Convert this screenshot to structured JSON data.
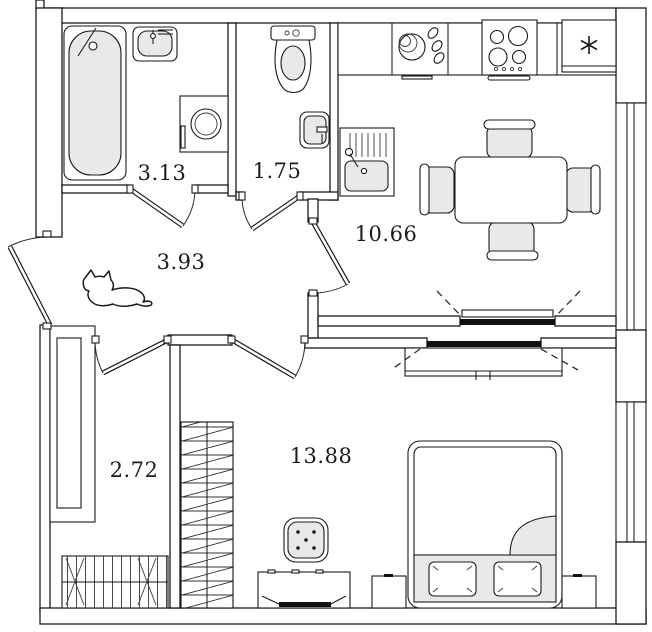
{
  "plan": {
    "type": "apartment-floor-plan",
    "rooms": [
      {
        "id": "bathroom",
        "area_label": "3.13"
      },
      {
        "id": "toilet",
        "area_label": "1.75"
      },
      {
        "id": "kitchen",
        "area_label": "10.66"
      },
      {
        "id": "hallway",
        "area_label": "3.93"
      },
      {
        "id": "corridor",
        "area_label": "2.72"
      },
      {
        "id": "bedroom",
        "area_label": "13.88"
      }
    ],
    "fixtures": [
      "bathtub",
      "bathroom-sink",
      "towel-rail",
      "washing-machine",
      "toilet",
      "toilet-sink",
      "kitchen-sink",
      "dish-rack",
      "stove",
      "fridge-asterisk",
      "dining-table",
      "chairs",
      "cat",
      "closet",
      "coat-rack",
      "wardrobe",
      "tv-console",
      "pouf",
      "bed",
      "pillows",
      "nightstand-left",
      "nightstand-right",
      "sliding-partition",
      "windows",
      "doors"
    ],
    "colors": {
      "wall": "#1a1a1a",
      "fixture_fill": "#e9e9e9",
      "background": "#ffffff",
      "label_text": "#1b1b1b"
    }
  }
}
